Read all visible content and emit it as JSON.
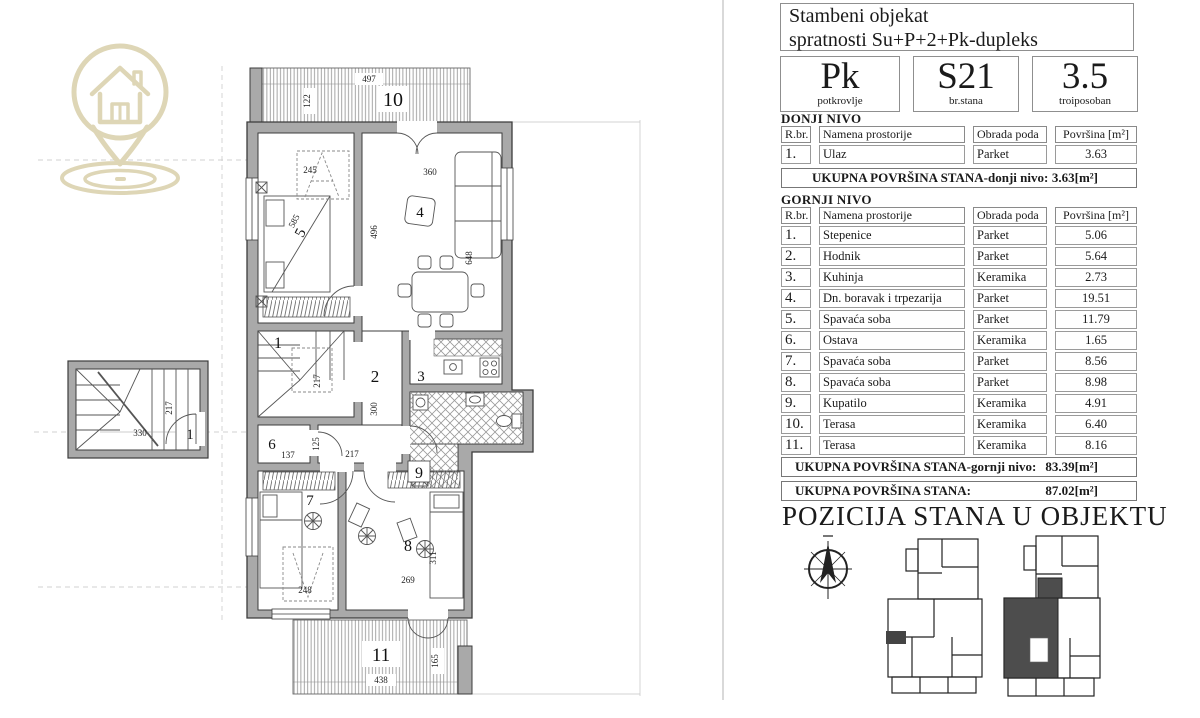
{
  "floor_plan": {
    "room_numbers": {
      "terrace_top": "10",
      "bedroom_main": "5",
      "living": "4",
      "stairs": "1",
      "hall": "2",
      "kitchen": "3",
      "storage": "6",
      "bedroom_b": "7",
      "bedroom_c": "8",
      "bath": "9",
      "terrace_bottom": "11",
      "entry_lower": "1"
    },
    "dimensions": {
      "t10_w": "497",
      "t10_h": "122",
      "bed5_w": "245",
      "bed5_d": "585",
      "liv_w": "360",
      "liv_h": "496",
      "liv_d": "648",
      "stairs_h": "217",
      "hall_h": "300",
      "hall_w": "217",
      "st6_w": "137",
      "st6_h": "125",
      "bed7_w": "248",
      "bed8_w": "269",
      "bed8_h": "311",
      "t11_w": "438",
      "t11_h": "165",
      "low_w": "330",
      "low_h": "217"
    }
  },
  "panel": {
    "title_line1": "Stambeni objekat",
    "title_line2": "spratnosti Su+P+2+Pk-dupleks",
    "badges": [
      {
        "value": "Pk",
        "label": "potkrovlje"
      },
      {
        "value": "S21",
        "label": "br.stana"
      },
      {
        "value": "3.5",
        "label": "troiposoban"
      }
    ],
    "columns": [
      "R.br.",
      "Namena prostorije",
      "Obrada poda",
      "Površina [m²]"
    ],
    "lower_level": {
      "heading": "DONJI NIVO",
      "rows": [
        [
          "1.",
          "Ulaz",
          "Parket",
          "3.63"
        ]
      ],
      "total_label": "UKUPNA POVRŠINA STANA-donji nivo:",
      "total_value": "3.63[m²]"
    },
    "upper_level": {
      "heading": "GORNJI NIVO",
      "rows": [
        [
          "1.",
          "Stepenice",
          "Parket",
          "5.06"
        ],
        [
          "2.",
          "Hodnik",
          "Parket",
          "5.64"
        ],
        [
          "3.",
          "Kuhinja",
          "Keramika",
          "2.73"
        ],
        [
          "4.",
          "Dn. boravak i trpezarija",
          "Parket",
          "19.51"
        ],
        [
          "5.",
          "Spavaća soba",
          "Parket",
          "11.79"
        ],
        [
          "6.",
          "Ostava",
          "Keramika",
          "1.65"
        ],
        [
          "7.",
          "Spavaća soba",
          "Parket",
          "8.56"
        ],
        [
          "8.",
          "Spavaća soba",
          "Parket",
          "8.98"
        ],
        [
          "9.",
          "Kupatilo",
          "Keramika",
          "4.91"
        ],
        [
          "10.",
          "Terasa",
          "Keramika",
          "6.40"
        ],
        [
          "11.",
          "Terasa",
          "Keramika",
          "8.16"
        ]
      ],
      "total_label": "UKUPNA POVRŠINA STANA-gornji nivo:",
      "total_value": "83.39[m²]"
    },
    "grand_total": {
      "label": "UKUPNA POVRŠINA STANA:",
      "value": "87.02[m²]"
    },
    "position_heading": "POZICIJA STANA U OBJEKTU"
  },
  "colors": {
    "wall": "#a9a9a9",
    "line": "#3c3c3c",
    "logo": "#ded6b6",
    "apartment_highlight": "#4d4d4d"
  }
}
